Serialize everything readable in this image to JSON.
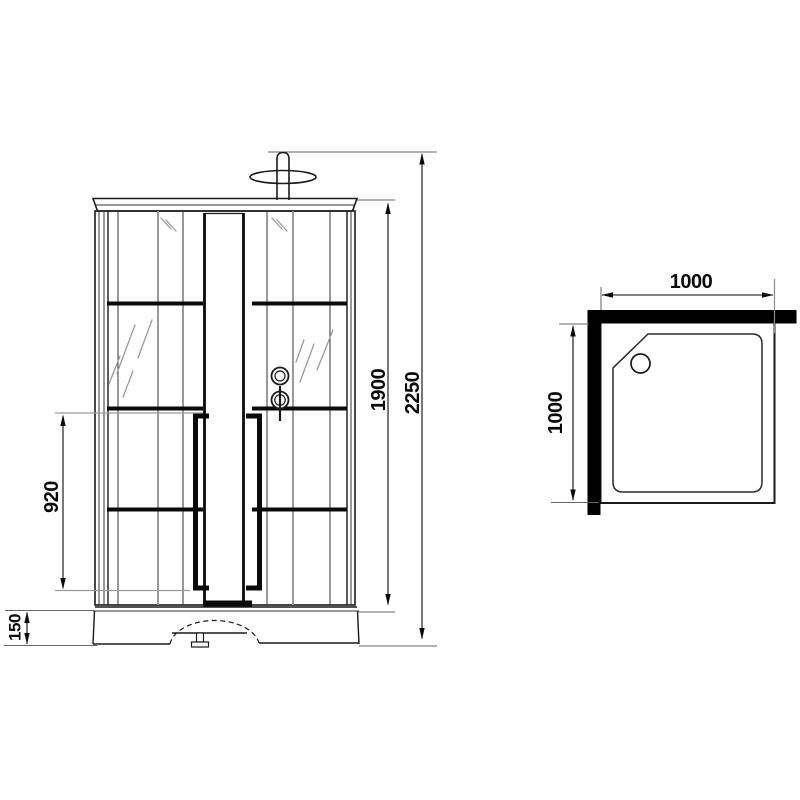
{
  "drawing": {
    "type": "technical-dimension-drawing",
    "subject": "shower-cabin",
    "views": {
      "front": {
        "dimensions": {
          "overall_height": "2250",
          "cabin_height": "1900",
          "door_handle_span": "920",
          "tray_height": "150"
        }
      },
      "top": {
        "dimensions": {
          "width": "1000",
          "depth": "1000"
        }
      }
    },
    "colors": {
      "line": "#1a1a1a",
      "fill_black": "#000000",
      "secondary_line": "#9a9a9a",
      "background": "#ffffff"
    }
  }
}
